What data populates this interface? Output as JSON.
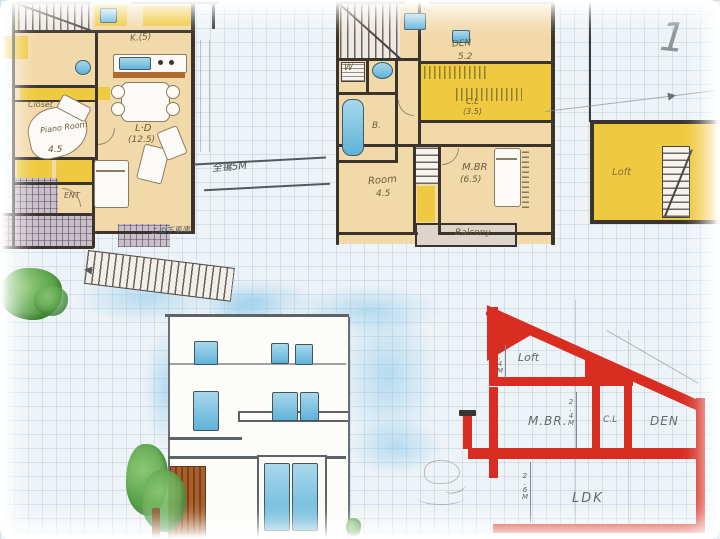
{
  "colors": {
    "paper": "#eef3f7",
    "wall": "#3a342d",
    "tan": "#f2d9a9",
    "yellow": "#efc93f",
    "red": "#d92d22",
    "blue": "#6fc0e0",
    "green": "#6ab35a",
    "doorbrown": "#a05a28"
  },
  "plan1": {
    "kitchen_label": "K.(5)",
    "ld_label": "L·D",
    "ld_size": "(12.5)",
    "closet_label": "Closet",
    "piano_label": "Piano Room",
    "piano_size": "4.5",
    "ent_label": "ENT",
    "dim_label": "全镵5M",
    "garage_note": "この下車庫"
  },
  "plan2": {
    "den_label": "DEN",
    "den_size": "5.2",
    "laundry_label": "W",
    "bath_label": "B.",
    "closet_label": "C.L",
    "closet_size": "(3.5)",
    "room_label": "Room",
    "room_size": "4.5",
    "mbr_label": "M.BR",
    "mbr_size": "(6.5)",
    "balcony_label": "Balcony"
  },
  "loft_plan": {
    "label": "Loft",
    "north_mark": "1"
  },
  "section": {
    "loft_label": "Loft",
    "loft_height": "1.4M",
    "mbr_label": "M.BR.",
    "mbr_height": "2.4M",
    "closet_label": "C.L",
    "den_label": "DEN",
    "ldk_label": "LDK",
    "ldk_height": "2.6M"
  }
}
